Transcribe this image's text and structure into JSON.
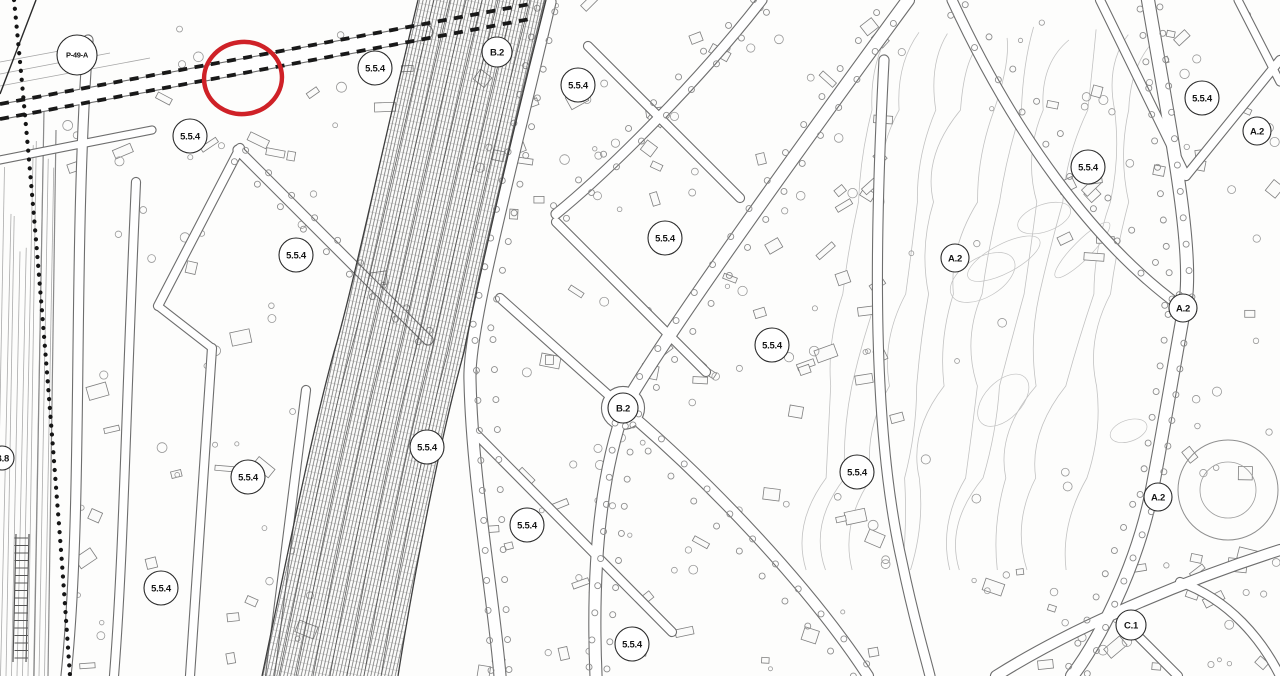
{
  "map": {
    "description": "scanned urban zoning plan with railway corridor",
    "background": "#fdfdfc",
    "colors": {
      "ink": "#6e6e6e",
      "light_ink": "#a8a8a8",
      "block_line": "#7f7f7f",
      "contour": "#c2c2c2",
      "hatch": "#585858",
      "band_edge": "#3f3f3f",
      "boundary": "#151515",
      "rail_dash": "#191919",
      "label_stroke": "#2a2a2a",
      "annotation": "#cf2127"
    },
    "annotation": {
      "type": "highlight-circle",
      "cx": 243,
      "cy": 78,
      "rx": 39,
      "ry": 36,
      "stroke_width": 4.5
    },
    "zone_labels": [
      {
        "text": "P-49-A",
        "x": 77,
        "y": 55,
        "r": 20
      },
      {
        "text": "5.5.4",
        "x": 190,
        "y": 136,
        "r": 17
      },
      {
        "text": "5.5.4",
        "x": 296,
        "y": 255,
        "r": 17
      },
      {
        "text": "5.5.4",
        "x": 375,
        "y": 68,
        "r": 17
      },
      {
        "text": "B.2",
        "x": 497,
        "y": 52,
        "r": 15
      },
      {
        "text": "5.5.4",
        "x": 578,
        "y": 85,
        "r": 17
      },
      {
        "text": "5.5.4",
        "x": 665,
        "y": 238,
        "r": 17
      },
      {
        "text": "5.5.4",
        "x": 772,
        "y": 345,
        "r": 17
      },
      {
        "text": "B.2",
        "x": 623,
        "y": 408,
        "r": 15
      },
      {
        "text": "5.5.4",
        "x": 427,
        "y": 447,
        "r": 17
      },
      {
        "text": "5.5.4",
        "x": 527,
        "y": 525,
        "r": 17
      },
      {
        "text": "5.5.4",
        "x": 248,
        "y": 477,
        "r": 17
      },
      {
        "text": "5.5.4",
        "x": 161,
        "y": 588,
        "r": 17
      },
      {
        "text": "5.5.4",
        "x": 857,
        "y": 472,
        "r": 17
      },
      {
        "text": "5.5.4",
        "x": 632,
        "y": 644,
        "r": 17
      },
      {
        "text": "A.2",
        "x": 955,
        "y": 258,
        "r": 14
      },
      {
        "text": "5.5.4",
        "x": 1088,
        "y": 167,
        "r": 17
      },
      {
        "text": "5.5.4",
        "x": 1202,
        "y": 98,
        "r": 17
      },
      {
        "text": "A.2",
        "x": 1257,
        "y": 131,
        "r": 14
      },
      {
        "text": "A.2",
        "x": 1183,
        "y": 308,
        "r": 14
      },
      {
        "text": "A.2",
        "x": 1158,
        "y": 497,
        "r": 14
      },
      {
        "text": "C.1",
        "x": 1131,
        "y": 625,
        "r": 15
      },
      {
        "text": "B.8",
        "x": 2,
        "y": 458,
        "r": 12
      }
    ]
  }
}
